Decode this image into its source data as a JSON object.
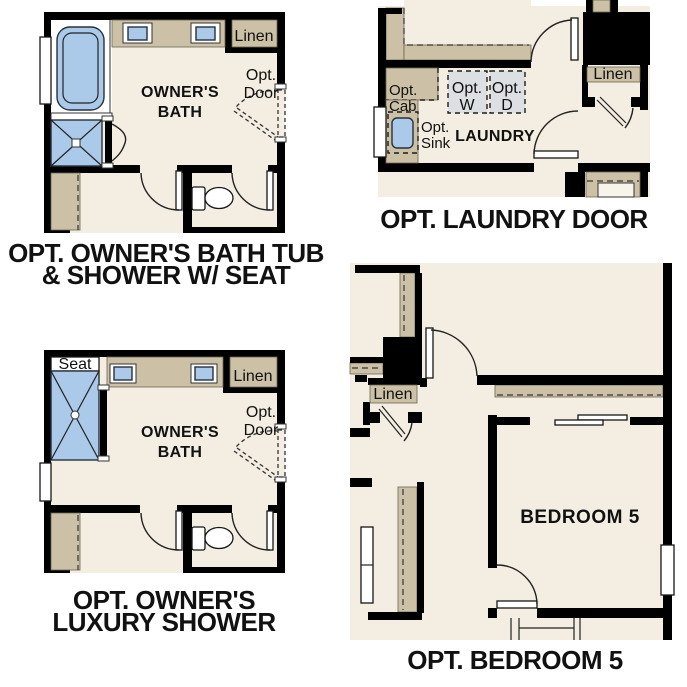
{
  "colors": {
    "page": "#ffffff",
    "floor": "#f3eee1",
    "wall": "#000000",
    "cabinet_tan": "#ccc1a6",
    "fixture_blue": "#abc9e9",
    "appliance_gray": "#dde0e3",
    "text": "#111111"
  },
  "panels": {
    "bath_tub": {
      "caption_line1": "OPT. OWNER'S BATH TUB",
      "caption_line2": "& SHOWER W/ SEAT",
      "room_label_line1": "OWNER'S",
      "room_label_line2": "BATH",
      "linen_label": "Linen",
      "opt_door_line1": "Opt.",
      "opt_door_line2": "Door"
    },
    "laundry": {
      "caption": "OPT. LAUNDRY DOOR",
      "room_label": "LAUNDRY",
      "linen_label": "Linen",
      "opt_washer_line1": "Opt.",
      "opt_washer_line2": "W",
      "opt_dryer_line1": "Opt.",
      "opt_dryer_line2": "D",
      "opt_cab_line1": "Opt.",
      "opt_cab_line2": "Cab",
      "opt_sink_line1": "Opt.",
      "opt_sink_line2": "Sink"
    },
    "luxury_shower": {
      "caption_line1": "OPT. OWNER'S",
      "caption_line2": "LUXURY SHOWER",
      "room_label_line1": "OWNER'S",
      "room_label_line2": "BATH",
      "seat_label": "Seat",
      "linen_label": "Linen",
      "opt_door_line1": "Opt.",
      "opt_door_line2": "Door"
    },
    "bedroom5": {
      "caption": "OPT. BEDROOM 5",
      "room_label": "BEDROOM 5",
      "linen_label": "Linen"
    }
  }
}
